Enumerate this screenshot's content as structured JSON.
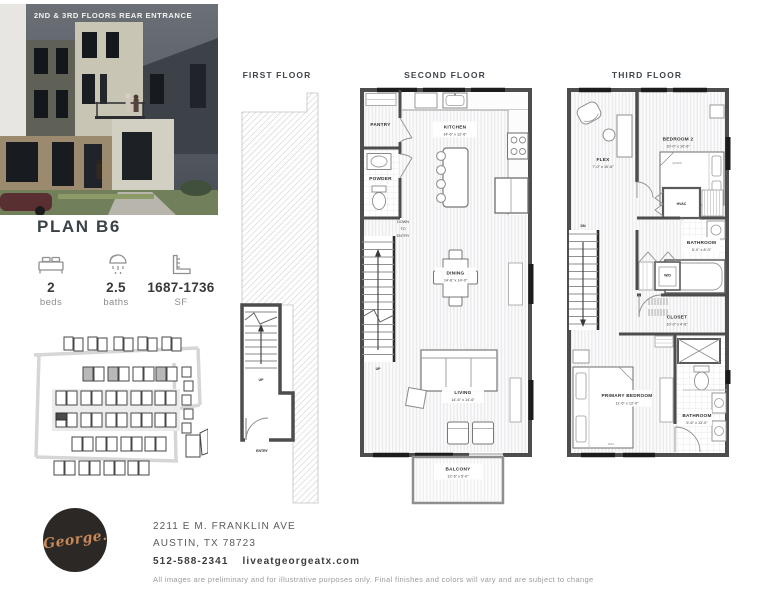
{
  "photo": {
    "caption": "2ND & 3RD FLOORS REAR ENTRANCE"
  },
  "plan": {
    "title": "PLAN B6"
  },
  "stats": {
    "beds_value": "2",
    "beds_label": "beds",
    "baths_value": "2.5",
    "baths_label": "baths",
    "sf_value": "1687-1736",
    "sf_label": "SF"
  },
  "floors": {
    "first": {
      "title": "FIRST FLOOR",
      "up": "UP",
      "entry": "ENTRY"
    },
    "second": {
      "title": "SECOND FLOOR",
      "pantry": "PANTRY",
      "powder": "POWDER",
      "kitchen": "KITCHEN",
      "kitchen_dims": "14'-6\" x 12'-6\"",
      "down1": "DOWN",
      "down2": "TO",
      "down3": "ENTRY",
      "up": "UP",
      "dining": "DINING",
      "dining_dims": "14'-6\" x 14'-0\"",
      "living": "LIVING",
      "living_dims": "14'-6\" x 14'-6\"",
      "balcony": "BALCONY",
      "balcony_dims": "12'-6\" x 5'-0\""
    },
    "third": {
      "title": "THIRD FLOOR",
      "flex": "FLEX",
      "flex_dims": "7'-0\" x 10'-6\"",
      "bedroom2": "BEDROOM 2",
      "bedroom2_dims": "10'-0\" x 10'-6\"",
      "queen": "QUEEN",
      "hvac": "HVAC",
      "dn": "DN",
      "bath2": "BATHROOM",
      "bath2_dims": "5'-0\" x 8'-0\"",
      "wd": "W/D",
      "closet": "CLOSET",
      "closet_dims": "10'-0\" x 4'-6\"",
      "primary": "PRIMARY BEDROOM",
      "primary_dims": "11'-6\" x 12'-0\"",
      "king": "KING",
      "bath_primary": "BATHROOM",
      "bath_primary_dims": "5'-6\" x 13'-0\""
    }
  },
  "contact": {
    "logo": "George.",
    "address1": "2211 E M. FRANKLIN AVE",
    "address2": "AUSTIN, TX 78723",
    "phone": "512-588-2341",
    "website": "liveatgeorgeatx.com"
  },
  "disclaimer": "All images are preliminary and for illustrative purposes only. Final finishes and colors will vary and are subject to change",
  "colors": {
    "accent": "#c78757",
    "logo_bg": "#2b2826",
    "wall": "#4d4d4d",
    "heading": "#3b4247"
  }
}
